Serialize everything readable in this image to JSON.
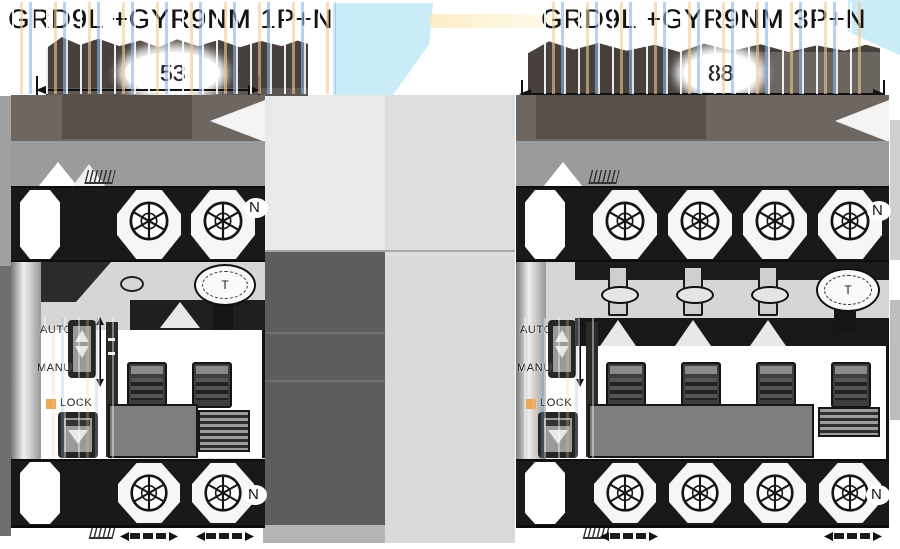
{
  "panels": {
    "left": {
      "title": "GRD9L +GYR9NM 1P+N",
      "width_dimension": "53",
      "neutral_top": "N",
      "neutral_bottom": "N",
      "test_button": "T",
      "auto": "AUTO",
      "manu": "MANU",
      "lock": "LOCK"
    },
    "right": {
      "title": "GRD9L +GYR9NM 3P+N",
      "width_dimension": "88",
      "neutral_top": "N",
      "neutral_bottom": "N",
      "test_button": "T",
      "auto": "AUTO",
      "manu": "MANU",
      "lock": "LOCK"
    }
  },
  "colors": {
    "glitch_blue": "#c9ecf8",
    "glitch_orange": "#f2c98e",
    "dimension_band": "#47403c",
    "brown_band": "#6e6661",
    "dark_brown": "#574e4a",
    "mid_gray": "#9b9b9b",
    "dark_column": "#5d5d5d",
    "light_column": "#d9d9d9",
    "lock_orange": "#f0a75a"
  }
}
